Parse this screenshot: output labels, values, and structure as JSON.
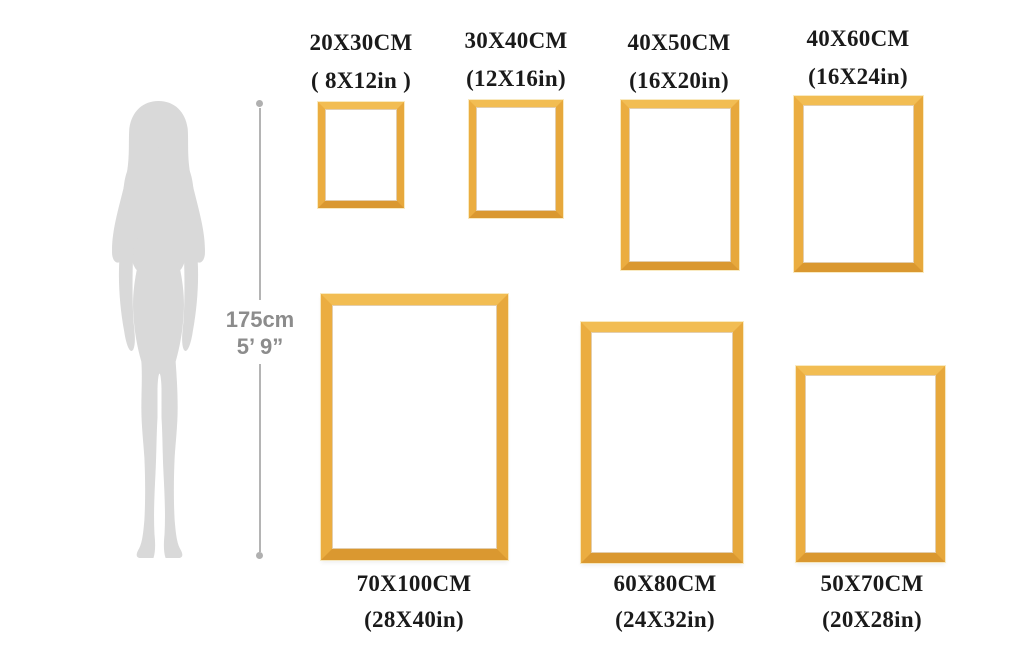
{
  "page": {
    "background": "#ffffff",
    "description": "Picture frame size comparison chart with woman silhouette for scale"
  },
  "reference": {
    "height_cm": "175cm",
    "height_ft": "5’ 9”",
    "silhouette": "woman-silhouette",
    "silhouette_color": "#d9d9d9",
    "line_color": "#b4b4b4",
    "text_color": "#8c8c8c"
  },
  "frame_style": {
    "gold_top": "#f2bd53",
    "gold_left": "#ebad40",
    "gold_right": "#e7a83c",
    "gold_bottom": "#da9830",
    "label_color": "#1a1a1a"
  },
  "frames": [
    {
      "cm": "20X30CM",
      "inch": "( 8X12in )"
    },
    {
      "cm": "30X40CM",
      "inch": "(12X16in)"
    },
    {
      "cm": "40X50CM",
      "inch": "(16X20in)"
    },
    {
      "cm": "40X60CM",
      "inch": "(16X24in)"
    },
    {
      "cm": "70X100CM",
      "inch": "(28X40in)"
    },
    {
      "cm": "60X80CM",
      "inch": "(24X32in)"
    },
    {
      "cm": "50X70CM",
      "inch": "(20X28in)"
    }
  ]
}
